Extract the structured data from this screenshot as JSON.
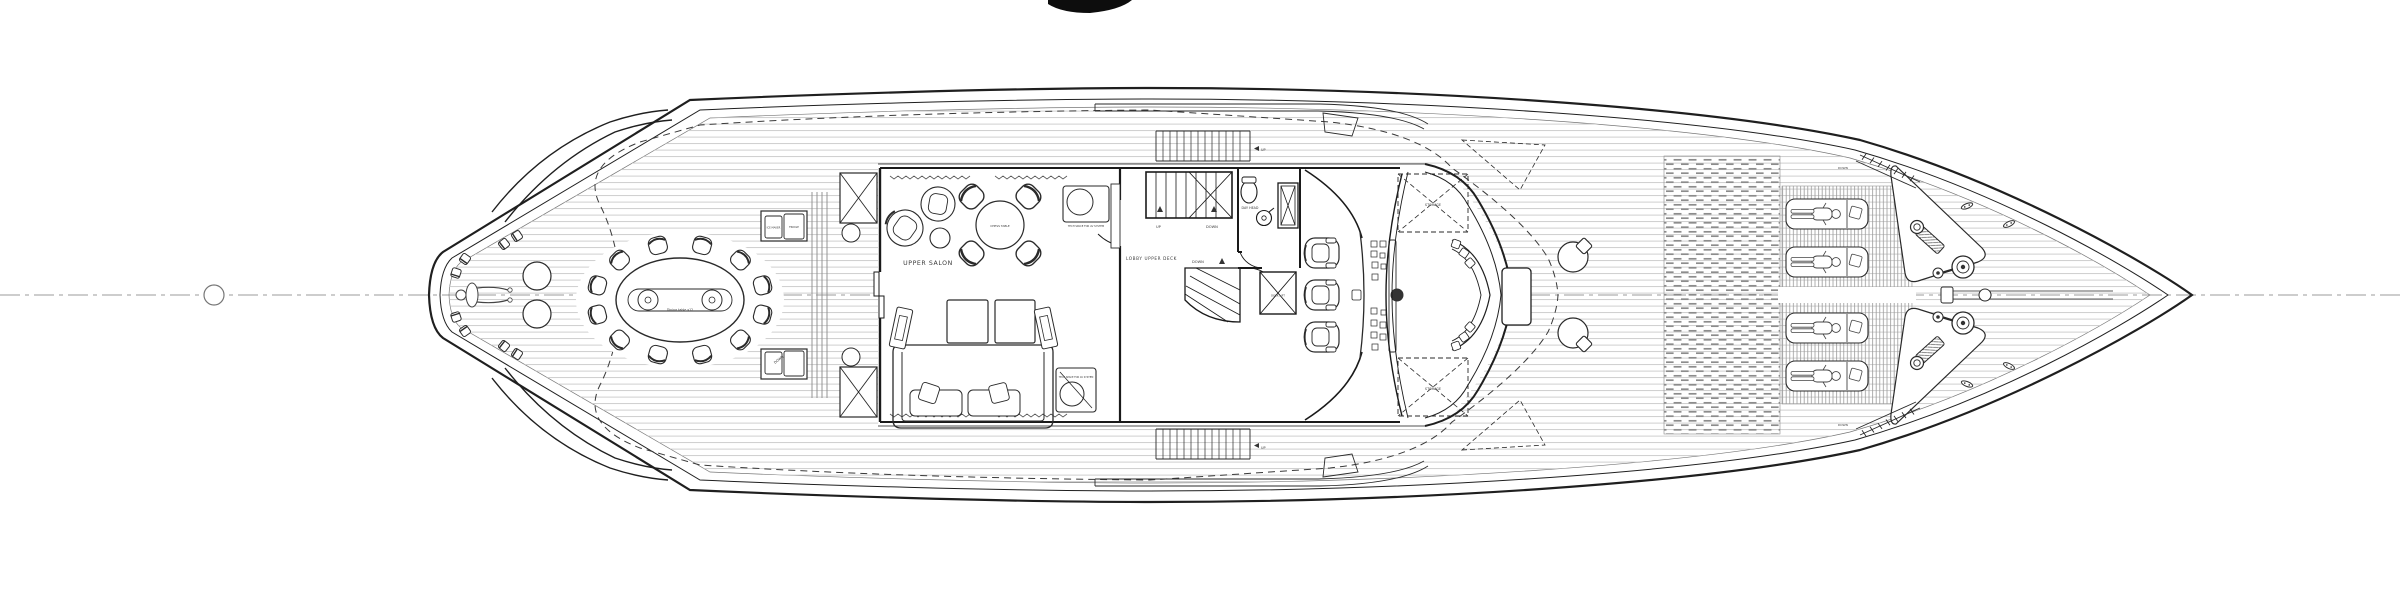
{
  "drawing": {
    "type": "yacht-upper-deck-general-arrangement-plan",
    "orientation": "bow-right, stern-left, symmetric about horizontal centerline"
  },
  "labels": {
    "upper_salon": "UPPER SALON",
    "chess_table": "CHESS TABLE",
    "lobby": "LOBBY UPPER DECK",
    "day_head": "DAY HEAD",
    "storage": "STORAGE",
    "ice_maker": "ICE MAKER",
    "fridge": "FRIDGE",
    "dining_table": "Dining table x12",
    "tech_space": "TECH SPACE FOR AV SYSTEM",
    "deck_lift": "DECK LIFT",
    "up": "UP",
    "down": "DOWN"
  },
  "features": {
    "dining_chairs": 12,
    "stern_cocktail_tables": 2,
    "stern_stools": 8,
    "salon_lounge_chairs": 2,
    "chess_chairs": 4,
    "helm_chairs": 3,
    "foredeck_pod_chairs": 2,
    "sun_loungers": 4,
    "people_figures": 5
  },
  "colors": {
    "line": "#1f1f1f",
    "plank": "#c9c9c9",
    "slat": "#9a9a9a",
    "mat": "#8c8c8c",
    "centerline": "#9b9b9b",
    "mast_fill": "#0d0d0d"
  }
}
